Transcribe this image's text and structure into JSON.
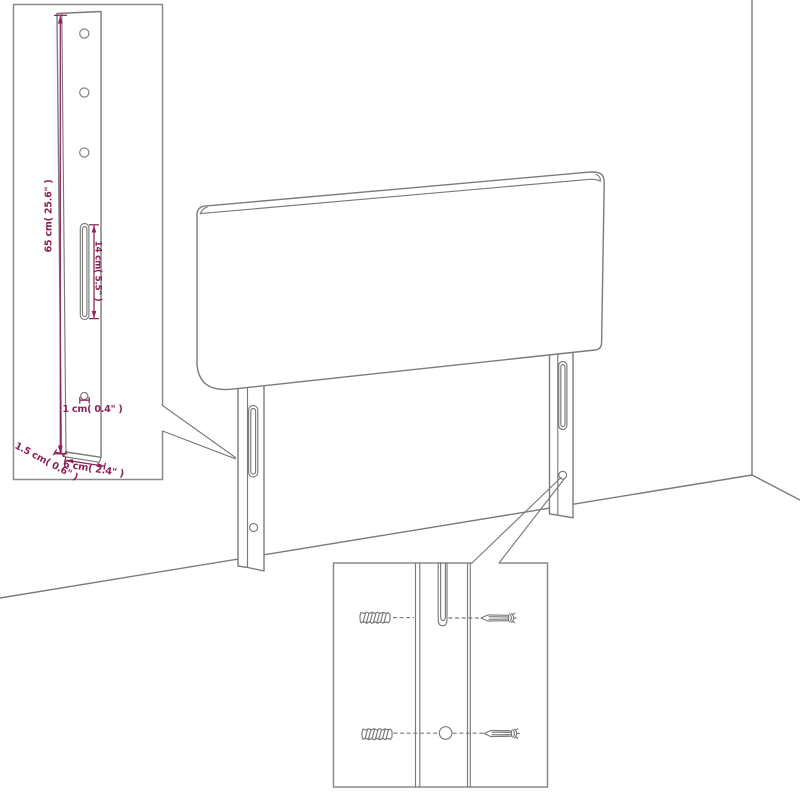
{
  "diagram": {
    "type": "furniture-assembly-dimension-diagram",
    "subject": "headboard-with-two-mounting-legs-against-wall-corner",
    "colors": {
      "background": "#ffffff",
      "line": "#7b7b7b",
      "dimension": "#8b2157"
    },
    "leg_detail_inset": {
      "dimensions": {
        "height": "65 cm( 25.6\" )",
        "slot_length": "14 cm( 5.5\" )",
        "hole_diameter": "1 cm( 0.4\" )",
        "depth": "1.5 cm( 0.6\" )",
        "width": "6 cm( 2.4\" )"
      },
      "features": {
        "top_holes": 3,
        "slots": 1,
        "anchor_holes": 1
      }
    },
    "mounting_inset": {
      "parts": [
        {
          "name": "wall-anchor",
          "icon": "wall-anchor-icon",
          "count": 2
        },
        {
          "name": "screw",
          "icon": "screw-icon",
          "count": 2
        }
      ]
    }
  }
}
